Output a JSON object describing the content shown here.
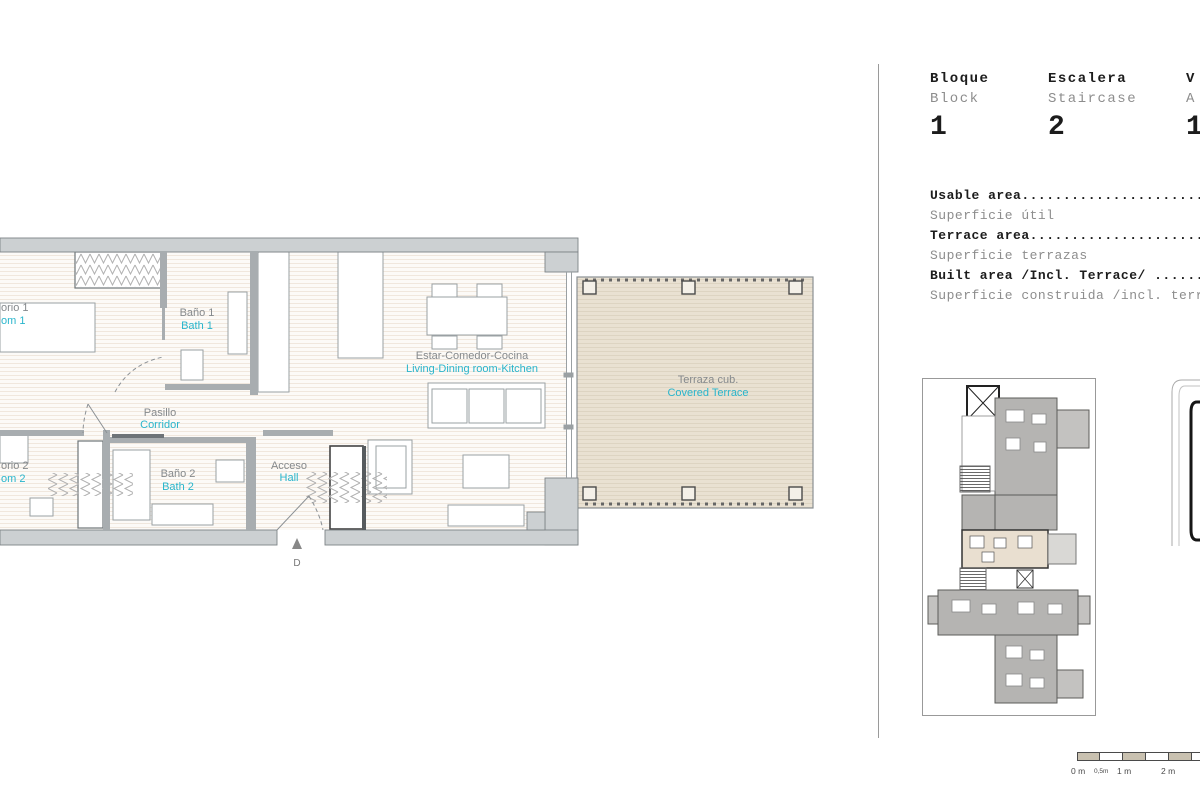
{
  "colors": {
    "accent_cyan": "#29b5cc",
    "label_gray": "#85898c",
    "wall_gray": "#ccd0d2",
    "terrace_beige": "#e9e1d2",
    "minimap_gray": "#b5b4b2"
  },
  "right_panel": {
    "header": {
      "columns": [
        {
          "es": "Bloque",
          "en": "Block",
          "value": "1"
        },
        {
          "es": "Escalera",
          "en": "Staircase",
          "value": "2"
        },
        {
          "es": "V",
          "en": "A",
          "value": "1"
        }
      ]
    },
    "area_rows": [
      {
        "primary": "Usable area..............................",
        "secondary": "Superficie útil"
      },
      {
        "primary": "Terrace area.............................",
        "secondary": "Superficie terrazas"
      },
      {
        "primary": "Built area /Incl. Terrace/ ..............",
        "secondary": "Superficie construida /incl. terrazas/"
      }
    ]
  },
  "floorplan": {
    "rooms": [
      {
        "id": "bedroom-1",
        "es": "orio 1",
        "en": "om 1"
      },
      {
        "id": "bath-1",
        "es": "Baño 1",
        "en": "Bath 1"
      },
      {
        "id": "corridor",
        "es": "Pasillo",
        "en": "Corridor"
      },
      {
        "id": "bedroom-2",
        "es": "orio 2",
        "en": "om 2"
      },
      {
        "id": "bath-2",
        "es": "Baño 2",
        "en": "Bath 2"
      },
      {
        "id": "hall",
        "es": "Acceso",
        "en": "Hall"
      },
      {
        "id": "living",
        "es": "Estar-Comedor-Cocina",
        "en": "Living-Dining room-Kitchen"
      },
      {
        "id": "terrace",
        "es": "Terraza cub.",
        "en": "Covered Terrace"
      }
    ],
    "entrance_label": "D"
  },
  "scale_bar": {
    "labels": [
      "0 m",
      "0,5m",
      "1 m",
      "2 m"
    ]
  }
}
